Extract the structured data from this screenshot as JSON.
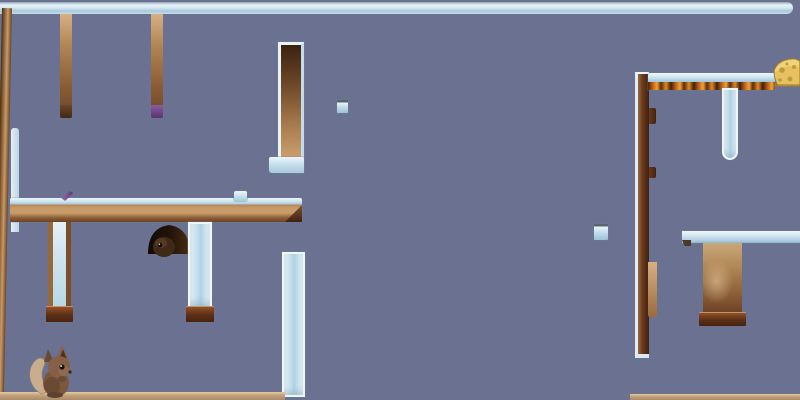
{
  "scene": {
    "name": "mouse-platformer-level",
    "background_color": "#6b7291",
    "viewport": {
      "width": 800,
      "height": 400
    },
    "palette": {
      "background": "#6b7291",
      "ice_light": "#eef6fa",
      "ice_mid": "#c2dcea",
      "ice_deep": "#9cc2d8",
      "wood_light": "#c79a67",
      "wood_mid": "#8a5c35",
      "wood_dark": "#432814",
      "base_dark": "#5d3018",
      "fire_orange": "#e08a22",
      "fire_dark": "#3a1d0c",
      "cheese_yellow": "#e7c160",
      "cheese_hole": "#bf9a3c",
      "purple_accent": "#7d4f93",
      "floor_tan": "#c3a37a",
      "mouse_body": "#7a573e",
      "mouse_tail": "#c9ad8f",
      "burrow_dark": "#1a0f08"
    },
    "objects": {
      "top_ice_bar": {
        "kind": "ice-platform",
        "x": 0,
        "y": 2,
        "w": 793,
        "h": 12
      },
      "left_wood_pillar": {
        "kind": "wood-pillar",
        "x": 2,
        "y": 8,
        "w": 10,
        "h": 386
      },
      "hang_pillar_a": {
        "kind": "wood-hanging-pillar",
        "x": 60,
        "y": 14,
        "w": 12,
        "h": 104
      },
      "hang_pillar_b": {
        "kind": "wood-hanging-pillar-purple-tip",
        "x": 151,
        "y": 14,
        "w": 12,
        "h": 104
      },
      "framed_wood_column": {
        "kind": "ice-framed-wood-column",
        "x": 278,
        "y": 42,
        "w": 26,
        "h": 131
      },
      "framed_column_foot": {
        "kind": "ice-foot",
        "x": 269,
        "y": 157,
        "w": 35,
        "h": 16
      },
      "ice_cube_a": {
        "kind": "small-ice-cube",
        "x": 337,
        "y": 100,
        "w": 11,
        "h": 13
      },
      "ice_cube_b": {
        "kind": "small-ice-cube",
        "x": 594,
        "y": 224,
        "w": 14,
        "h": 16
      },
      "left_ice_sliver": {
        "kind": "ice-wall-thin",
        "x": 11,
        "y": 128,
        "w": 8,
        "h": 104
      },
      "main_platform": {
        "kind": "wood-ice-platform",
        "x": 10,
        "y": 198,
        "w": 292,
        "h": 24
      },
      "purple_item": {
        "kind": "purple-shard-item",
        "x": 61,
        "y": 192,
        "w": 13,
        "h": 8
      },
      "ice_item": {
        "kind": "small-ice-box-item",
        "x": 234,
        "y": 191,
        "w": 13,
        "h": 10
      },
      "burrow": {
        "kind": "dark-burrow-with-creature",
        "x": 147,
        "y": 222,
        "w": 44,
        "h": 32
      },
      "leg_left": {
        "kind": "ice-leg-wood-rails",
        "x": 48,
        "y": 222,
        "w": 23,
        "h": 86
      },
      "leg_left_foot": {
        "kind": "dark-wood-foot",
        "x": 46,
        "y": 306,
        "w": 27,
        "h": 16
      },
      "leg_right": {
        "kind": "ice-leg",
        "x": 188,
        "y": 222,
        "w": 24,
        "h": 86
      },
      "leg_right_foot": {
        "kind": "dark-wood-foot",
        "x": 186,
        "y": 306,
        "w": 28,
        "h": 16
      },
      "mid_ice_column": {
        "kind": "tall-ice-column",
        "x": 282,
        "y": 252,
        "w": 23,
        "h": 145
      },
      "left_floor": {
        "kind": "wood-floor",
        "x": 0,
        "y": 392,
        "w": 285,
        "h": 8
      },
      "right_floor": {
        "kind": "wood-floor",
        "x": 630,
        "y": 394,
        "w": 170,
        "h": 6
      },
      "right_dark_pillar": {
        "kind": "dark-wood-pillar-ice-edge",
        "x": 635,
        "y": 72,
        "w": 14,
        "h": 286
      },
      "nub_a": {
        "kind": "wood-nub",
        "x": 649,
        "y": 108,
        "w": 7,
        "h": 16
      },
      "nub_b": {
        "kind": "wood-nub",
        "x": 649,
        "y": 167,
        "w": 7,
        "h": 11
      },
      "light_wood_strip": {
        "kind": "light-wood-strip",
        "x": 648,
        "y": 262,
        "w": 9,
        "h": 55
      },
      "fire_platform": {
        "kind": "ice-platform-fire-underside",
        "x": 648,
        "y": 73,
        "w": 127,
        "h": 17
      },
      "cheese": {
        "kind": "cheese-goal",
        "x": 773,
        "y": 55,
        "w": 27,
        "h": 32
      },
      "right_ice_hang": {
        "kind": "hanging-ice-pillar",
        "x": 722,
        "y": 88,
        "w": 16,
        "h": 72
      },
      "right_mid_platform": {
        "kind": "ice-platform",
        "x": 682,
        "y": 231,
        "w": 118,
        "h": 12
      },
      "right_wood_block": {
        "kind": "wood-block",
        "x": 703,
        "y": 243,
        "w": 39,
        "h": 70
      },
      "right_wood_base": {
        "kind": "dark-wood-foot",
        "x": 699,
        "y": 312,
        "w": 47,
        "h": 14
      },
      "mouse": {
        "kind": "player-mouse",
        "x": 26,
        "y": 340,
        "w": 50,
        "h": 58
      }
    }
  }
}
